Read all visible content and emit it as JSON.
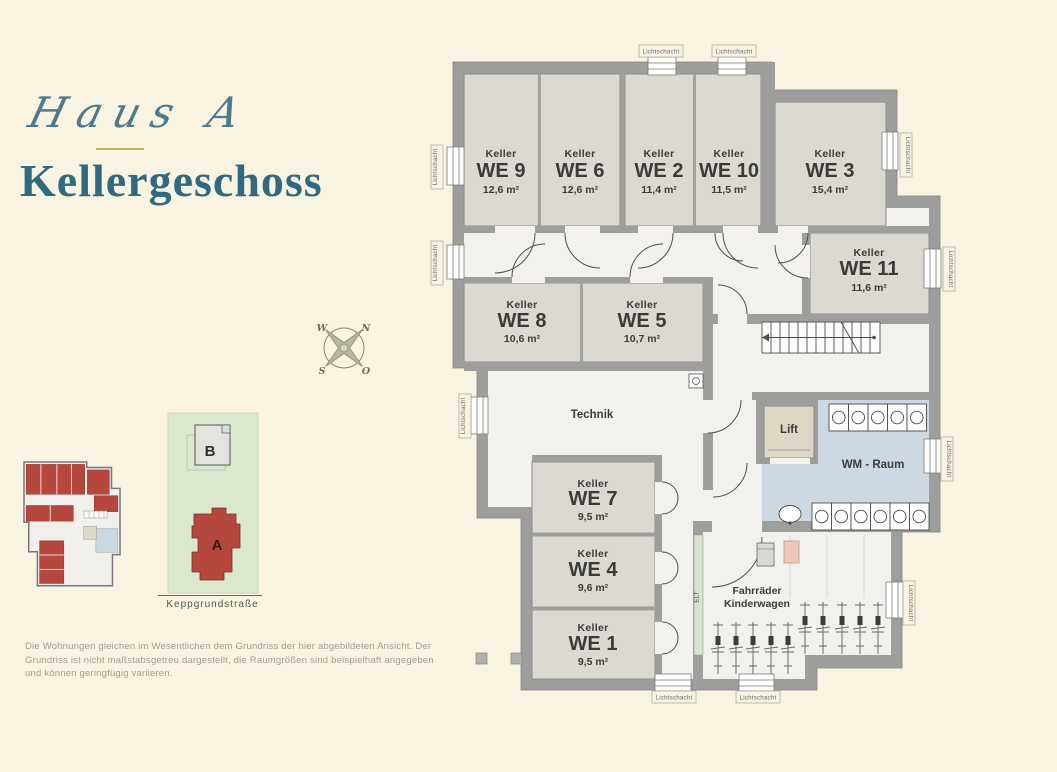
{
  "header": {
    "script_title": "Haus A",
    "main_title": "Kellergeschoss"
  },
  "compass": {
    "west": "W",
    "north": "N",
    "south": "S",
    "east": "O"
  },
  "site_plan": {
    "building_a": "A",
    "building_b": "B",
    "street": "Keppgrundstraße"
  },
  "plan": {
    "lichtschacht": "Lichtschacht",
    "technik": "Technik",
    "lift": "Lift",
    "wm_raum": "WM - Raum",
    "elt": "ELT",
    "fahrraeder": "Fahrräder",
    "kinderwagen": "Kinderwagen",
    "rooms": [
      {
        "type": "Keller",
        "we": "WE 9",
        "area": "12,6 m²"
      },
      {
        "type": "Keller",
        "we": "WE 6",
        "area": "12,6 m²"
      },
      {
        "type": "Keller",
        "we": "WE 2",
        "area": "11,4 m²"
      },
      {
        "type": "Keller",
        "we": "WE 10",
        "area": "11,5 m²"
      },
      {
        "type": "Keller",
        "we": "WE 3",
        "area": "15,4 m²"
      },
      {
        "type": "Keller",
        "we": "WE 11",
        "area": "11,6 m²"
      },
      {
        "type": "Keller",
        "we": "WE 8",
        "area": "10,6 m²"
      },
      {
        "type": "Keller",
        "we": "WE 5",
        "area": "10,7 m²"
      },
      {
        "type": "Keller",
        "we": "WE 7",
        "area": "9,5 m²"
      },
      {
        "type": "Keller",
        "we": "WE 4",
        "area": "9,6 m²"
      },
      {
        "type": "Keller",
        "we": "WE 1",
        "area": "9,5 m²"
      }
    ]
  },
  "disclaimer": {
    "line1": "Die Wohnungen gleichen im Wesentlichen dem Grundriss der hier abgebildeten Ansicht. Der",
    "line2": "Grundriss ist nicht maßstabsgetreu dargestellt, die Raumgrößen sind beispielhaft angegeben",
    "line3": "und können geringfügig variieren."
  },
  "colors": {
    "accent_teal": "#2f6a80",
    "accent_gold": "#c8b44d",
    "building_red": "#b5473e",
    "wall_gray": "#9e9e9c",
    "wm_blue": "#cdd9e2",
    "site_green": "#dce8cd",
    "background_cream": "#f9f4e2"
  }
}
